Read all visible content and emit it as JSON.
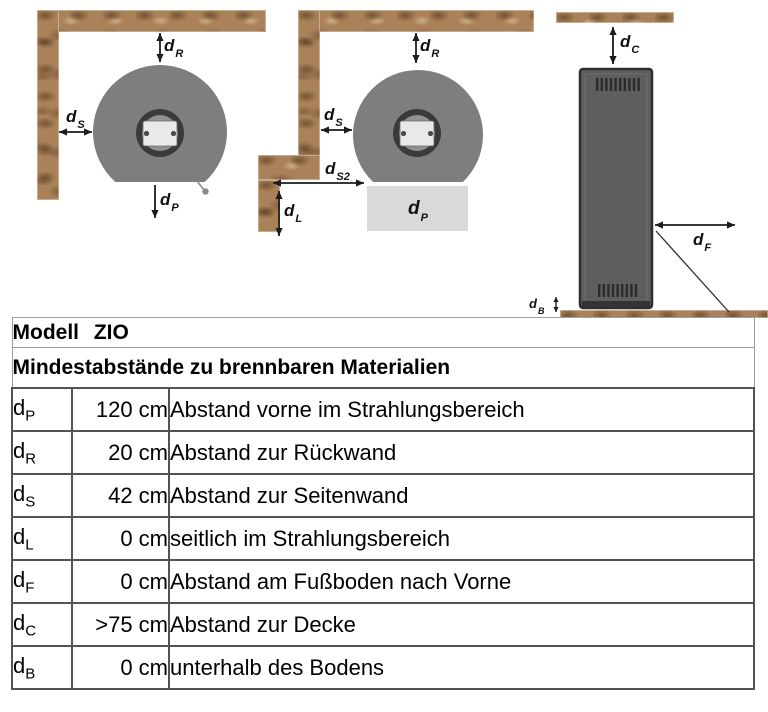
{
  "colors": {
    "wall_wood": "#aa8158",
    "stove_top_gray": "#7e7e7e",
    "stove_side_gray": "#5e5e5e",
    "flue_ring_dark": "#3a3a3a",
    "flue_panel_light": "#e9e9e9",
    "radiation_area_light": "#d9d9d9",
    "table_border_dark": "#515358",
    "table_border_light": "#9b9da0"
  },
  "diagrams": {
    "corner_view": {
      "labels": {
        "dR": {
          "base": "d",
          "sub": "R"
        },
        "dS": {
          "base": "d",
          "sub": "S"
        },
        "dP": {
          "base": "d",
          "sub": "P"
        }
      }
    },
    "corner_step_view": {
      "labels": {
        "dR": {
          "base": "d",
          "sub": "R"
        },
        "dS": {
          "base": "d",
          "sub": "S"
        },
        "dS2": {
          "base": "d",
          "sub": "S2"
        },
        "dL": {
          "base": "d",
          "sub": "L"
        },
        "dP": {
          "base": "d",
          "sub": "P"
        }
      }
    },
    "side_view": {
      "labels": {
        "dC": {
          "base": "d",
          "sub": "C"
        },
        "dF": {
          "base": "d",
          "sub": "F"
        },
        "dB": {
          "base": "d",
          "sub": "B"
        }
      }
    }
  },
  "table": {
    "title": "Modell ZIO",
    "subtitle": "Mindestabstände zu brennbaren Materialien",
    "rows": [
      {
        "sym": {
          "base": "d",
          "sub": "P"
        },
        "value": "120 cm",
        "desc": "Abstand vorne im Strahlungsbereich"
      },
      {
        "sym": {
          "base": "d",
          "sub": "R"
        },
        "value": "20 cm",
        "desc": "Abstand zur Rückwand"
      },
      {
        "sym": {
          "base": "d",
          "sub": "S"
        },
        "value": "42 cm",
        "desc": "Abstand zur Seitenwand"
      },
      {
        "sym": {
          "base": "d",
          "sub": "L"
        },
        "value": "0 cm",
        "desc": "seitlich im Strahlungsbereich"
      },
      {
        "sym": {
          "base": "d",
          "sub": "F"
        },
        "value": "0 cm",
        "desc": "Abstand am Fußboden nach Vorne"
      },
      {
        "sym": {
          "base": "d",
          "sub": "C"
        },
        "value": ">75 cm",
        "desc": "Abstand zur Decke"
      },
      {
        "sym": {
          "base": "d",
          "sub": "B"
        },
        "value": "0 cm",
        "desc": "unterhalb des Bodens"
      }
    ]
  }
}
